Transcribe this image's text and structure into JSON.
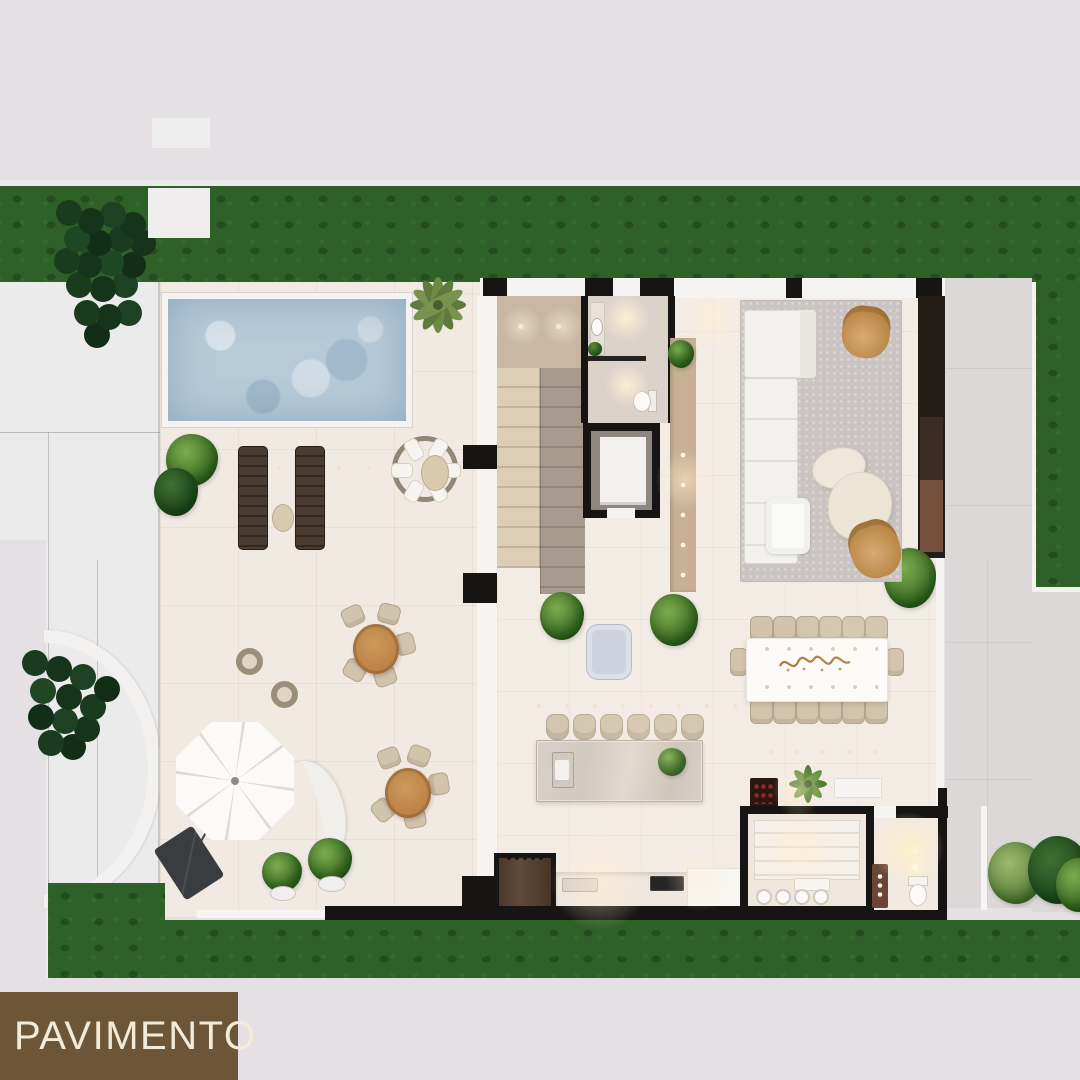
{
  "label": {
    "pavimento": "PAVIMENTO"
  },
  "colors": {
    "bg": "#e4e0e4",
    "grass": "#2e6128",
    "tree-dark": "#16341a",
    "plant-green": "#55992f",
    "terrace": "#f1eae3",
    "floor": "#f3ece5",
    "pool": "#b6cad8",
    "wall-black": "#171513",
    "wall-white": "#f5f4f2",
    "driveway": "#ecebec",
    "path-grey": "#dcd8d7",
    "stair-light": "#ddcdb7",
    "stair-dark": "#a89b8e",
    "landing": "#c9b7a3",
    "wood": "#c28a4b",
    "beige": "#d2c3ac",
    "rug": "#cac5c3",
    "sofa": "#f3f1ee",
    "tan": "#c08a52",
    "media-dark": "#241d18",
    "media-wood": "#75503c",
    "marble": "#d8d1c8",
    "cabinet-brown": "#544133",
    "wine-dark": "#2b1712",
    "umbrella": "#fbfaf9",
    "pouf-blue": "#ccd3dd",
    "bath-floor": "#dbd2ca",
    "console": "#c7b093",
    "label-box": "#6d5638",
    "label-text": "#f3ebd9"
  },
  "scene": {
    "type": "architectural-floor-plan-render-top-view",
    "areas": [
      "garden-strip",
      "pool",
      "pool-terrace",
      "sun-loungers",
      "round-daybed",
      "outdoor-dining",
      "parasol-lounge",
      "driveway",
      "staircase",
      "elevator",
      "powder-room",
      "hallway-console",
      "living-room",
      "dining-room",
      "kitchen-island",
      "kitchen",
      "pantry-cellar",
      "wc",
      "side-path",
      "rear-lawn"
    ]
  }
}
